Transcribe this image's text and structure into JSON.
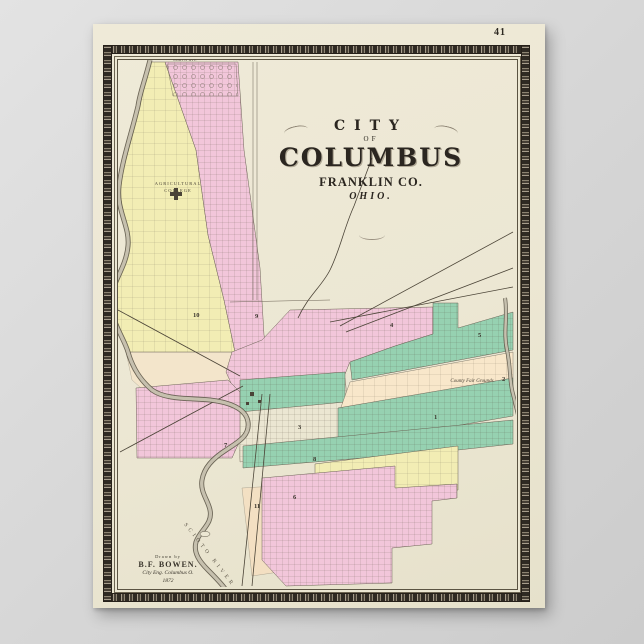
{
  "poster": {
    "page_number": "41"
  },
  "title": {
    "arc": "CITY",
    "of": "OF",
    "main": "COLUMBUS",
    "sub": "FRANKLIN CO.",
    "state": "OHIO."
  },
  "attribution": {
    "line1": "Drawn by",
    "line2": "B.F. BOWEN.",
    "line3": "City Eng. Columbus O.",
    "line4": "1872"
  },
  "labels": {
    "college_line1": "AGRICULTURAL",
    "college_line2": "COLLEGE",
    "fair_grounds": "County Fair Grounds",
    "river": "SCIOTO RIVER",
    "street_top": "NORTH AVE"
  },
  "wards": {
    "w1": "1",
    "w2": "2",
    "w3": "3",
    "w4": "4",
    "w5": "5",
    "w6": "6",
    "w7": "7",
    "w8": "8",
    "w9": "9",
    "w10": "10",
    "w11": "11"
  },
  "colors": {
    "mat_gray": "#d8d8d8",
    "paper_cream": "#ece7d3",
    "frame_dark": "#2f2a23",
    "ward_pink": "#f2c6da",
    "ward_yellow": "#f2edb4",
    "ward_green": "#96d1b1",
    "ward_peach": "#f8e7ca",
    "river_gray": "#c6c0ae",
    "ink": "#3a352c"
  }
}
